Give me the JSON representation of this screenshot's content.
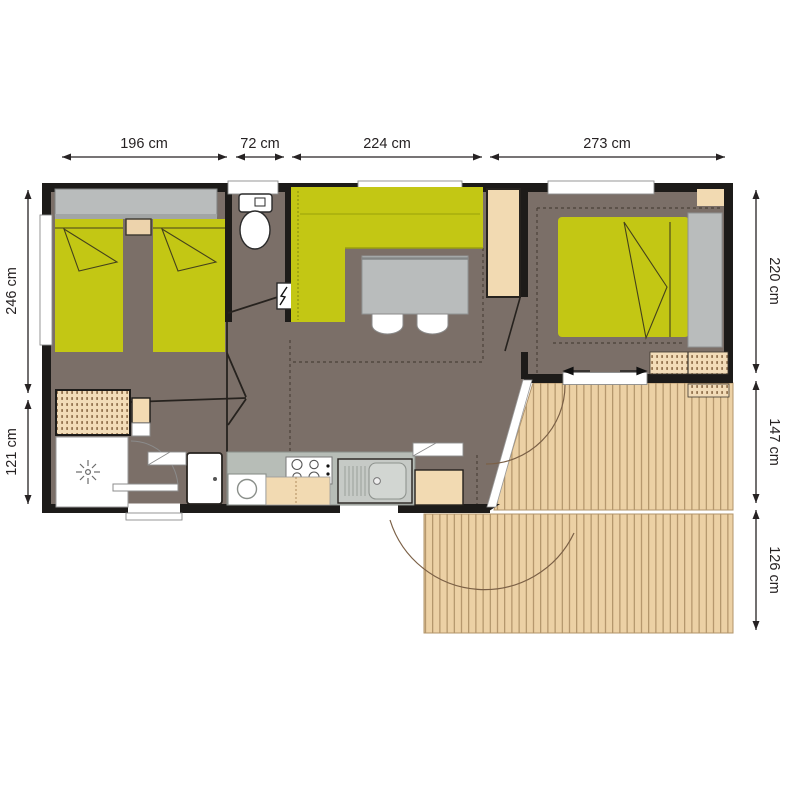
{
  "figure": {
    "type": "floor-plan",
    "subject": "Mobile home floor plan with wooden deck terrace"
  },
  "dimensions": {
    "top": [
      "196 cm",
      "72 cm",
      "224 cm",
      "273 cm"
    ],
    "left": [
      "246 cm",
      "121 cm"
    ],
    "right": [
      "220 cm",
      "147 cm",
      "126 cm"
    ]
  },
  "colors": {
    "furniture_green": "#c3c714",
    "floor_brown": "#7b6f68",
    "deck_wood": "#ecd1a5",
    "deck_plank_line": "#a5875c",
    "cabinet_beige": "#f2dab2",
    "fixture_gray": "#b9bcbc",
    "wall_black": "#1d1b19",
    "dimension_text": "#262223"
  },
  "legend": {
    "rooms": [
      "twin bedroom",
      "toilet",
      "living room",
      "master bedroom",
      "shower room",
      "kitchen",
      "deck"
    ]
  }
}
